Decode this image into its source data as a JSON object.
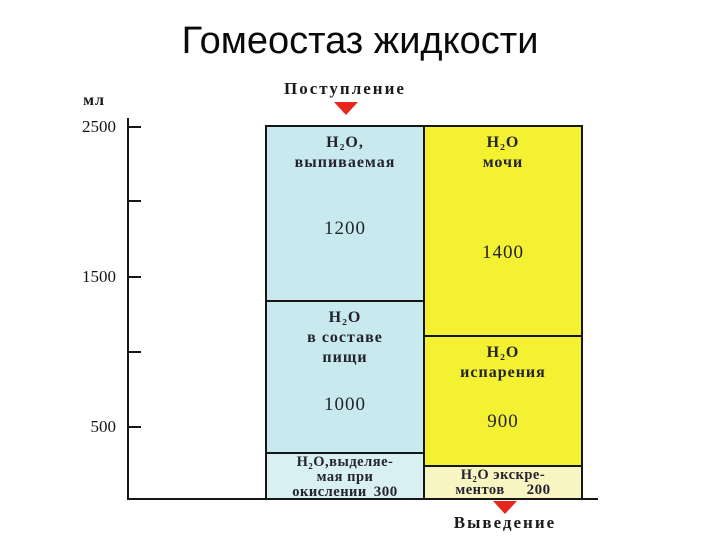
{
  "title": "Гомеостаз жидкости",
  "colors": {
    "intake_fill": "#c8e9ee",
    "intake_bottom_fill": "#d9f0f3",
    "output_fill": "#f3f132",
    "output_bottom_fill": "#f8f5c2",
    "arrow_red": "#e7271d",
    "line_dark": "#161616",
    "text_dark": "#23232e"
  },
  "axis": {
    "unit": "мл",
    "tick_2500": "2500",
    "tick_1500": "1500",
    "tick_500": "500"
  },
  "intake": {
    "header": "Поступление",
    "blocks": [
      {
        "l1": "H₂O,",
        "l2": "выпиваемая",
        "value": "1200"
      },
      {
        "l1": "H₂O",
        "l2": "в составе",
        "l3": "пищи",
        "value": "1000"
      },
      {
        "l1": "H₂O,выделяе-",
        "l2": "мая при",
        "l3": "окислении",
        "value": "300"
      }
    ]
  },
  "output": {
    "footer": "Выведение",
    "blocks": [
      {
        "l1": "H₂O",
        "l2": "мочи",
        "value": "1400"
      },
      {
        "l1": "H₂O",
        "l2": "испарения",
        "value": "900"
      },
      {
        "l1": "H₂O экскре-",
        "l2": "ментов",
        "value": "200"
      }
    ]
  },
  "chart_data": {
    "type": "bar",
    "orientation": "stacked-vertical",
    "title": "Гомеостаз жидкости",
    "ylabel": "мл",
    "ylim": [
      0,
      2500
    ],
    "yticks_labeled": [
      2500,
      1500,
      500
    ],
    "yticks_unlabeled": [
      2000,
      1000
    ],
    "grid": false,
    "legend": false,
    "columns": [
      {
        "name": "Поступление",
        "total": 2500,
        "segments": [
          {
            "label": "H₂O, выпиваемая",
            "value": 1200
          },
          {
            "label": "H₂O в составе пищи",
            "value": 1000
          },
          {
            "label": "H₂O, выделяемая при окислении",
            "value": 300
          }
        ]
      },
      {
        "name": "Выведение",
        "total": 2500,
        "segments": [
          {
            "label": "H₂O мочи",
            "value": 1400
          },
          {
            "label": "H₂O испарения",
            "value": 900
          },
          {
            "label": "H₂O экскрементов",
            "value": 200
          }
        ]
      }
    ]
  }
}
